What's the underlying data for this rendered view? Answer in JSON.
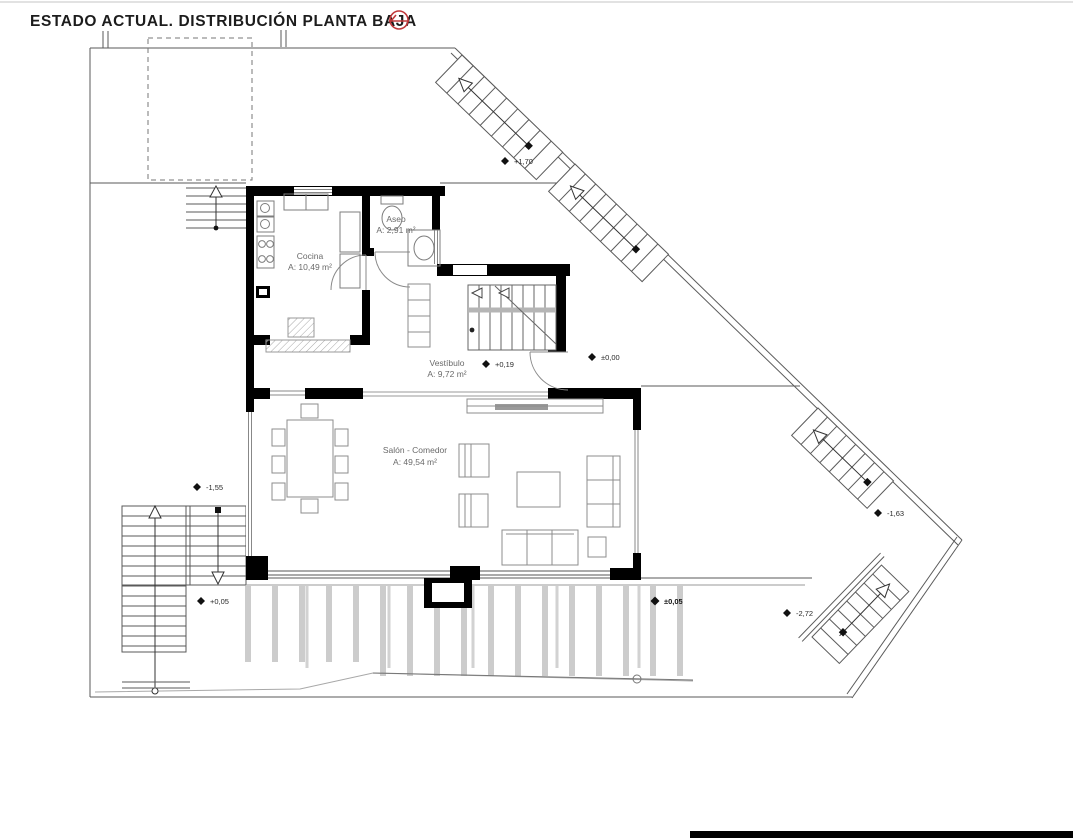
{
  "title": "ESTADO ACTUAL. DISTRIBUCIÓN PLANTA BAJA",
  "plan": {
    "rooms": [
      {
        "name": "Cocina",
        "area": "A: 10,49 m²"
      },
      {
        "name": "Aseo",
        "area": "A: 2,91 m²"
      },
      {
        "name": "Vestíbulo",
        "area": "A: 9,72 m²"
      },
      {
        "name": "Salón - Comedor",
        "area": "A: 49,54 m²"
      }
    ],
    "level_markers": [
      {
        "value": "+1,70"
      },
      {
        "value": "±0,00"
      },
      {
        "value": "+0,19"
      },
      {
        "value": "-1,55"
      },
      {
        "value": "-1,63"
      },
      {
        "value": "+0,05"
      },
      {
        "value": "±0,05"
      },
      {
        "value": "-2,72"
      }
    ],
    "colors": {
      "wall": "#000000",
      "site_line": "#5a5a5a",
      "furniture_line": "#8c8c8c",
      "label_text": "#6a6a6a",
      "accent_red": "#c0393b"
    }
  }
}
